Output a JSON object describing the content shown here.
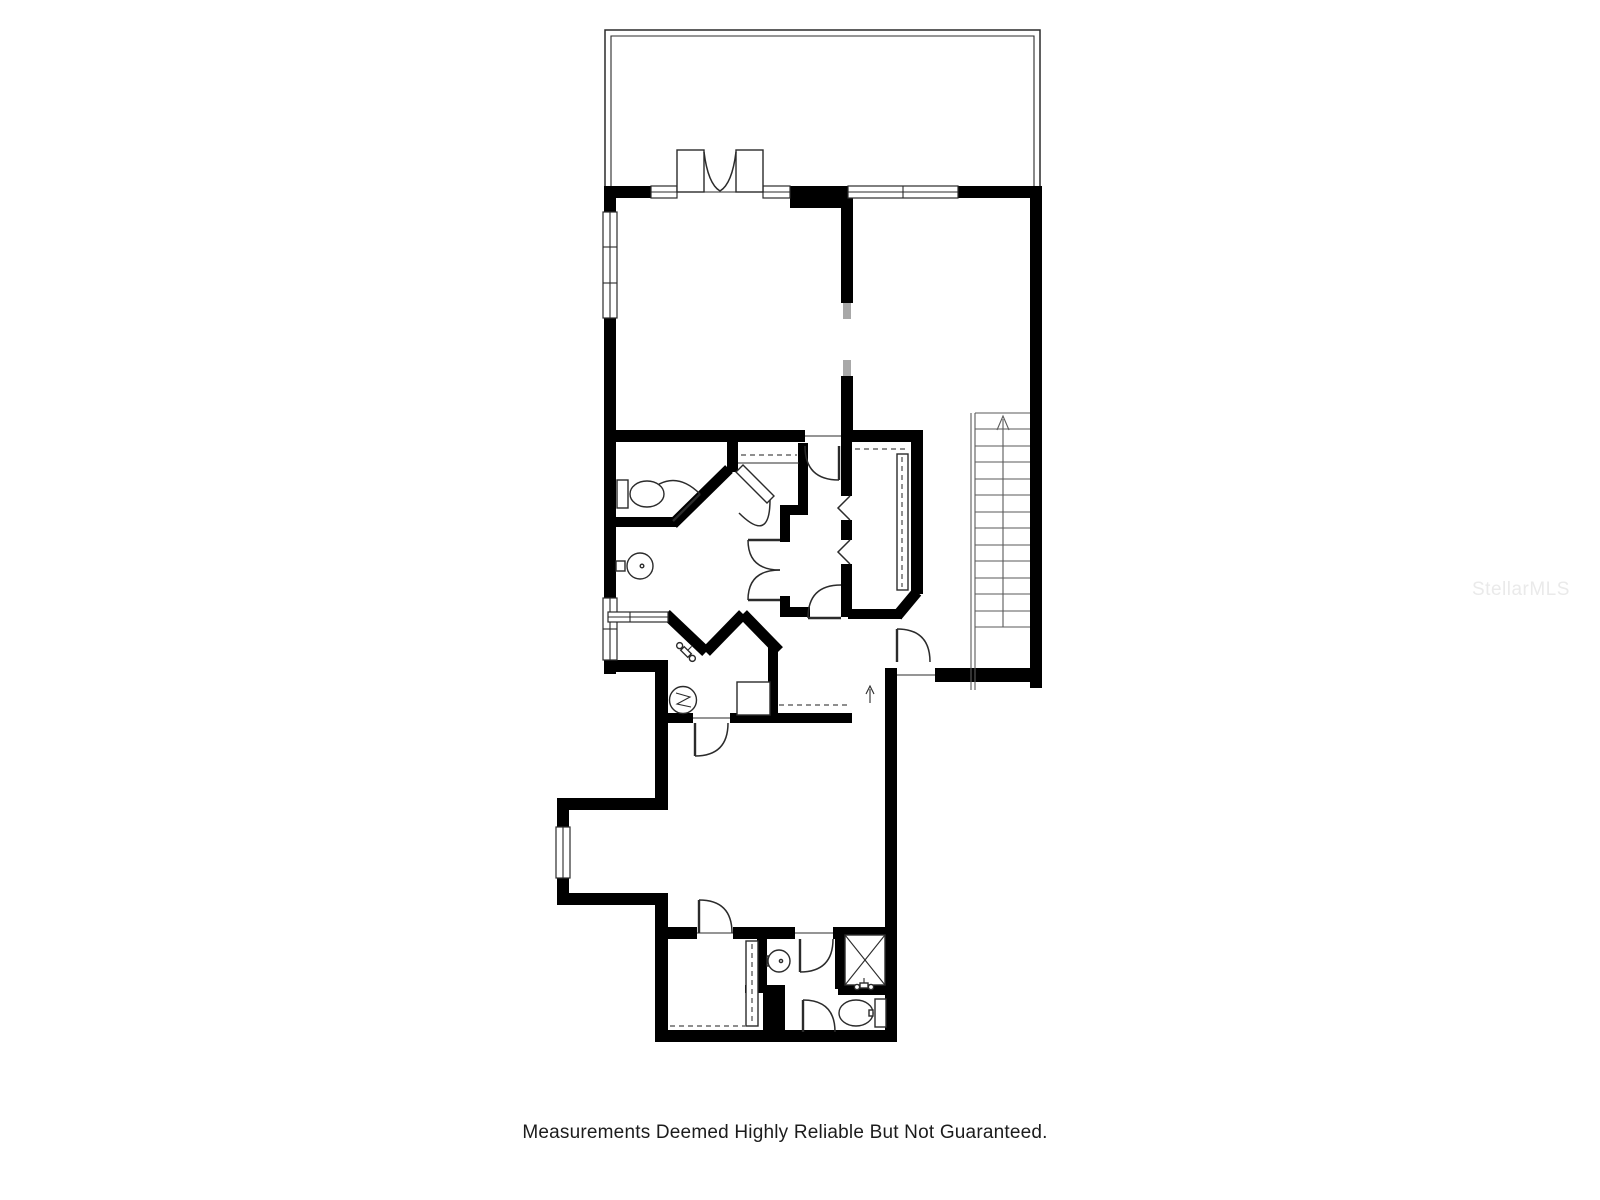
{
  "canvas": {
    "width": 1600,
    "height": 1200,
    "background": "#ffffff"
  },
  "colors": {
    "wall": "#000000",
    "line": "#2b2b2b",
    "light_line": "#4a4a4a",
    "opening_jamb": "#a8a8a8",
    "watermark": "#eaeaea",
    "text": "#1c1c1c",
    "background": "#ffffff"
  },
  "footer": {
    "disclaimer": "Measurements Deemed Highly Reliable But Not Guaranteed."
  },
  "watermark": {
    "text": "StellarMLS"
  },
  "floor_plan": {
    "type": "residential-floor-plan",
    "stairs": {
      "treads": 14,
      "direction_arrow": "up"
    },
    "entry_arrow": "up",
    "symbols": [
      "patio-outline",
      "french-doors",
      "window",
      "toilet",
      "pedestal-sink",
      "shower-glass",
      "shower-faucet",
      "water-heater",
      "appliance",
      "walk-in-closet-shelf",
      "bifold-doors",
      "closet-rod-dashes",
      "stair-run",
      "shower-stall-x",
      "door-swing-arc"
    ]
  }
}
